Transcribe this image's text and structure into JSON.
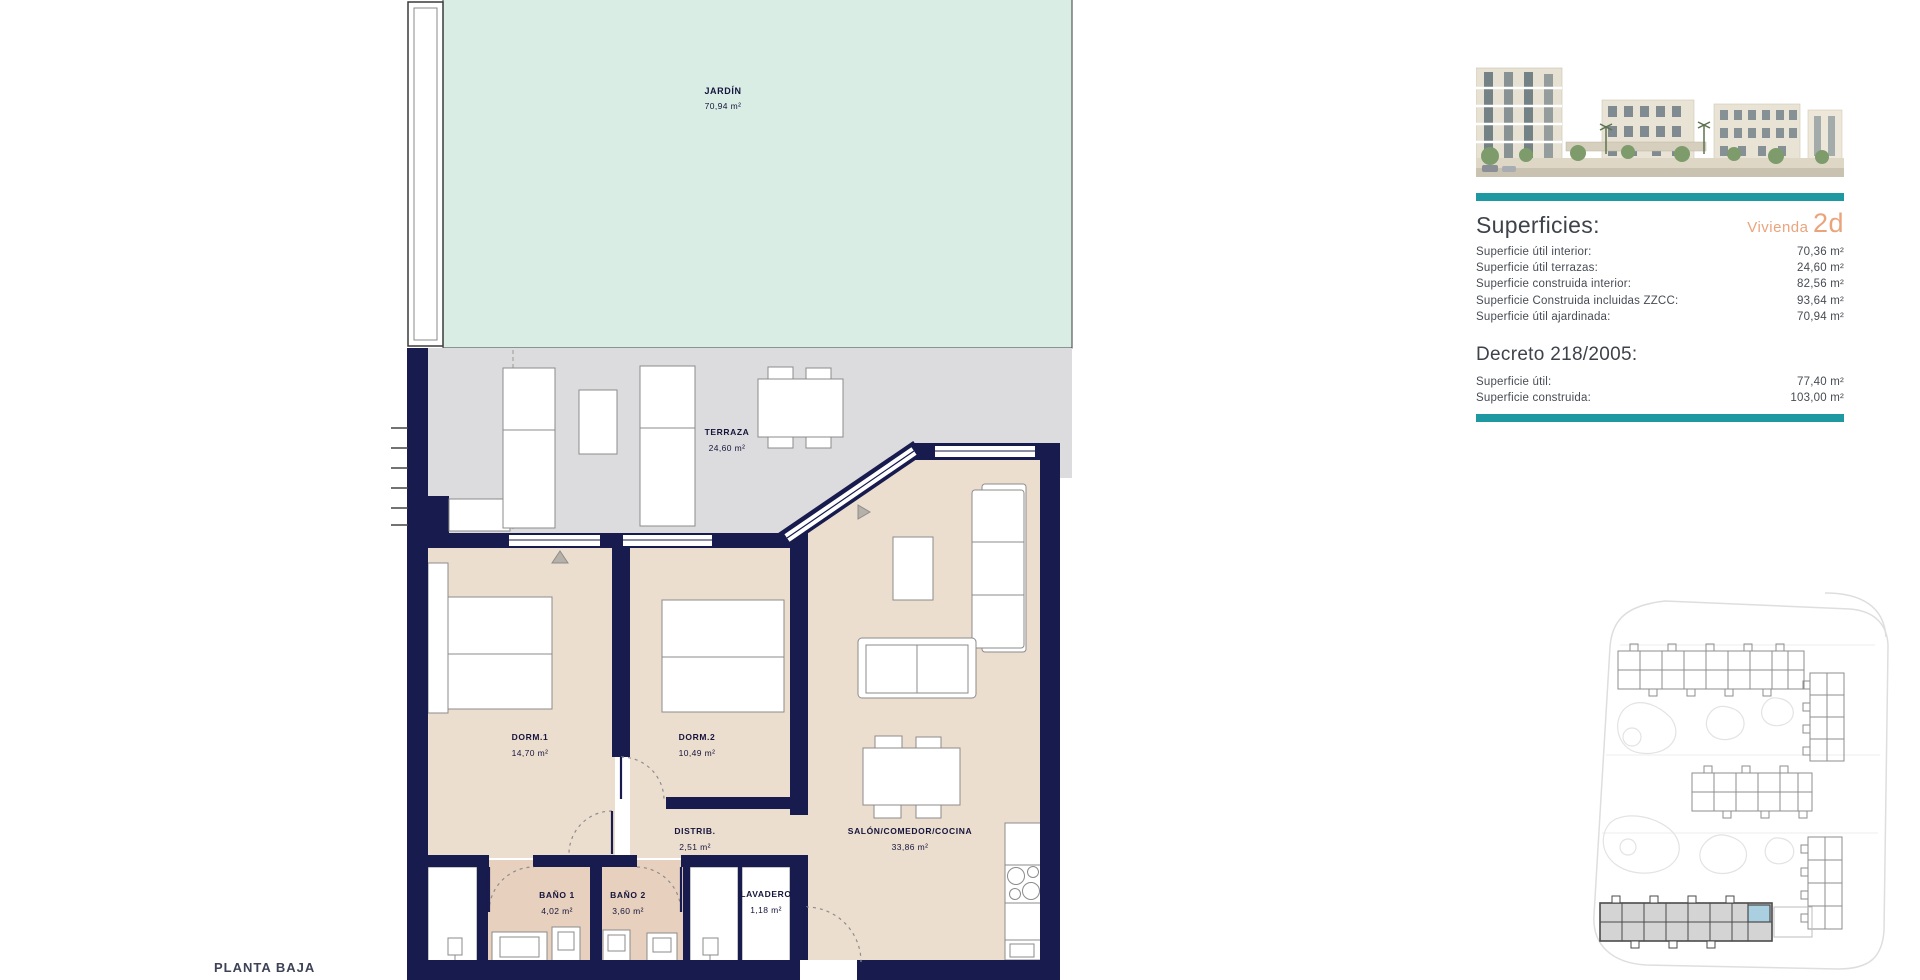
{
  "plan": {
    "title": "PLANTA BAJA",
    "rooms": [
      {
        "name": "JARDÍN",
        "area": "70,94 m²"
      },
      {
        "name": "TERRAZA",
        "area": "24,60 m²"
      },
      {
        "name": "DORM.1",
        "area": "14,70 m²"
      },
      {
        "name": "DORM.2",
        "area": "10,49 m²"
      },
      {
        "name": "DISTRIB.",
        "area": "2,51 m²"
      },
      {
        "name": "SALÓN/COMEDOR/COCINA",
        "area": "33,86 m²"
      },
      {
        "name": "BAÑO 1",
        "area": "4,02 m²"
      },
      {
        "name": "BAÑO 2",
        "area": "3,60 m²"
      },
      {
        "name": "LAVADERO",
        "area": "1,18 m²"
      }
    ]
  },
  "panel": {
    "superficies": {
      "title": "Superficies:",
      "vivienda_label": "Vivienda",
      "vivienda_code": "2d",
      "rows": [
        {
          "label": "Superficie útil interior:",
          "value": "70,36 m²"
        },
        {
          "label": "Superficie útil terrazas:",
          "value": "24,60 m²"
        },
        {
          "label": "Superficie construida interior:",
          "value": "82,56 m²"
        },
        {
          "label": "Superficie Construida incluidas ZZCC:",
          "value": "93,64 m²"
        },
        {
          "label": "Superficie útil ajardinada:",
          "value": "70,94 m²"
        }
      ]
    },
    "decreto": {
      "title": "Decreto 218/2005:",
      "rows": [
        {
          "label": "Superficie útil:",
          "value": "77,40 m²"
        },
        {
          "label": "Superficie construida:",
          "value": "103,00 m²"
        }
      ]
    }
  },
  "colors": {
    "wall_navy": "#181b4e",
    "garden_mint": "#d9ede5",
    "terrace_gray": "#dcdcde",
    "interior_beige": "#ecdecf",
    "bath_beige": "#e7d0bd",
    "accent_teal": "#1e99a1",
    "accent_orange": "#eaa47c",
    "highlight_unit_blue": "#aacfe0"
  }
}
